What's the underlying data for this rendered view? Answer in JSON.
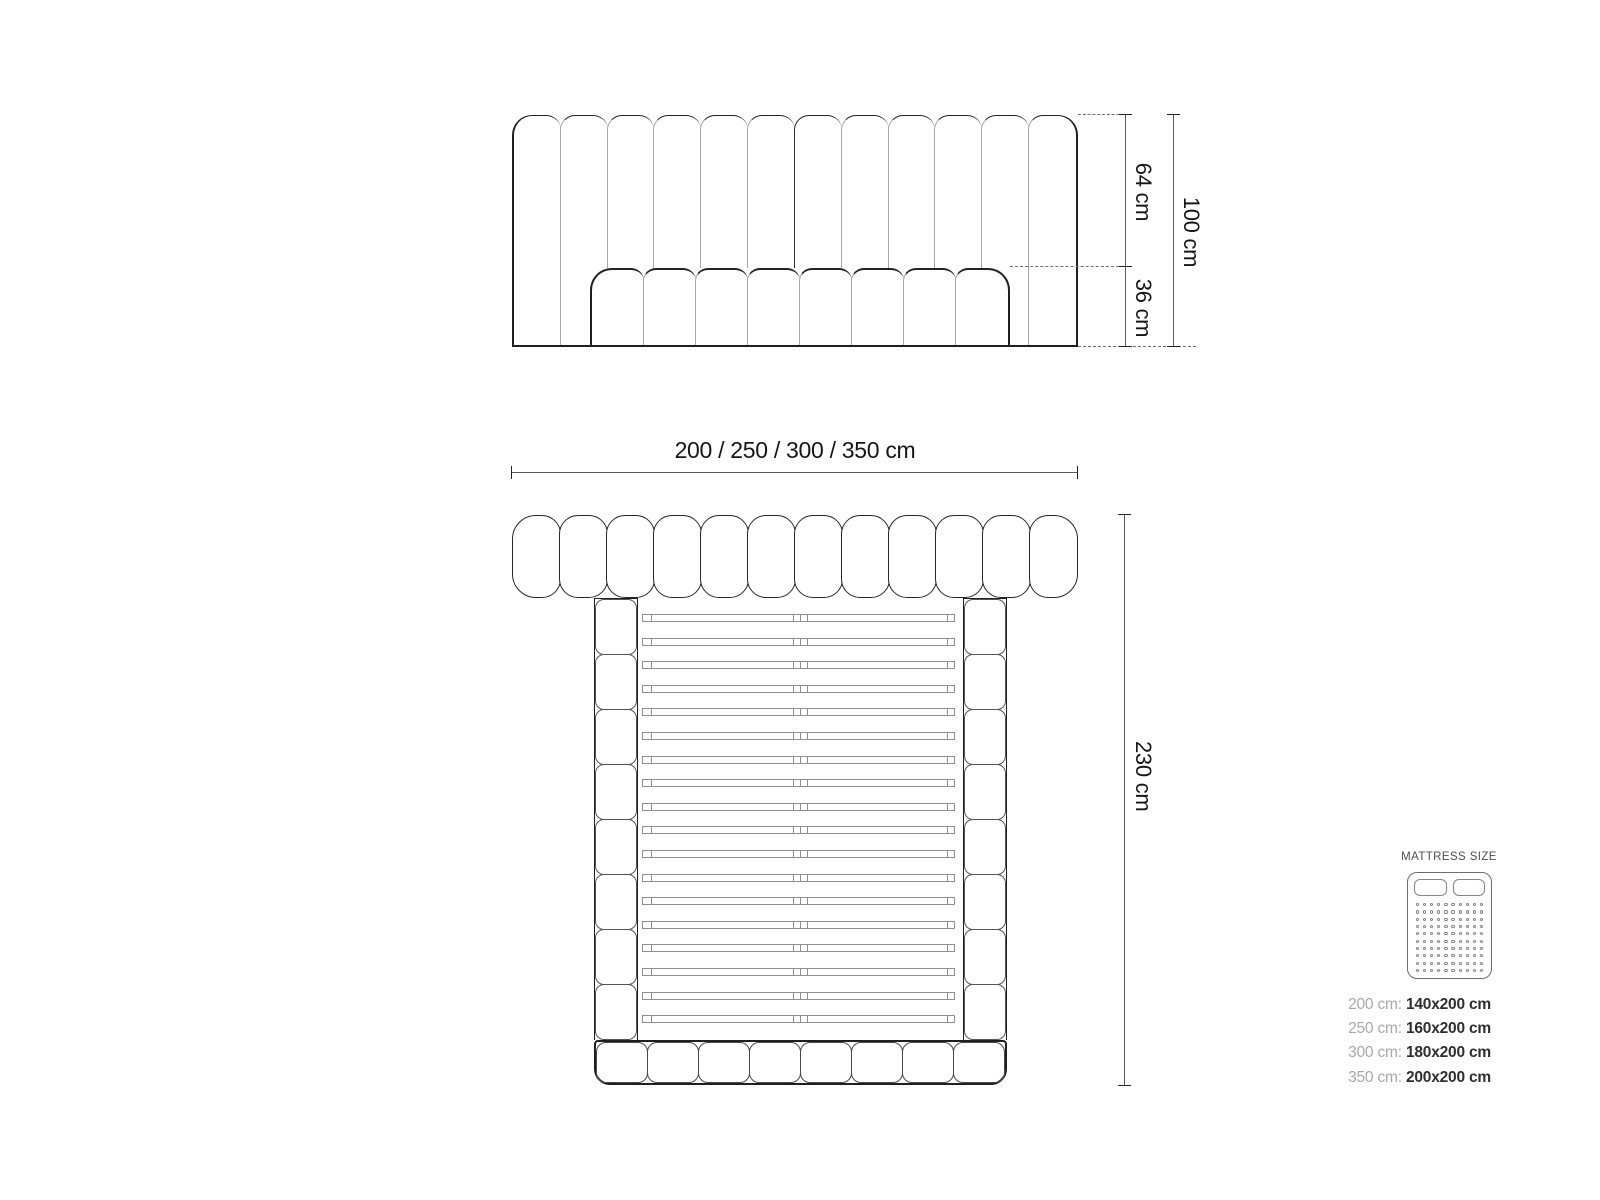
{
  "front_view": {
    "headboard_panels": 12,
    "base_cushions": 8,
    "dim_upper": "64 cm",
    "dim_lower": "36 cm",
    "dim_total": "100 cm"
  },
  "plan_view": {
    "width_dim": "200 / 250 / 300 / 350 cm",
    "depth_dim": "230 cm",
    "headboard_tufts": 12,
    "rail_tufts_per_side": 8,
    "footboard_tufts": 8,
    "slat_count": 18
  },
  "legend": {
    "title": "MATTRESS SIZE",
    "icon": {
      "pillows": 2,
      "dot_rows": 10,
      "dot_cols": 10
    },
    "rows": [
      {
        "frame": "200 cm:",
        "mattress": "140x200 cm"
      },
      {
        "frame": "250 cm:",
        "mattress": "160x200 cm"
      },
      {
        "frame": "300 cm:",
        "mattress": "180x200 cm"
      },
      {
        "frame": "350 cm:",
        "mattress": "200x200 cm"
      }
    ]
  },
  "colors": {
    "outline_dark": "#1f1f1f",
    "seam_light": "#a6a6a6",
    "dim_line": "#5a5a5a",
    "label_text": "#161616",
    "legend_label": "#a8a8a8",
    "legend_value": "#2e2e2e"
  }
}
